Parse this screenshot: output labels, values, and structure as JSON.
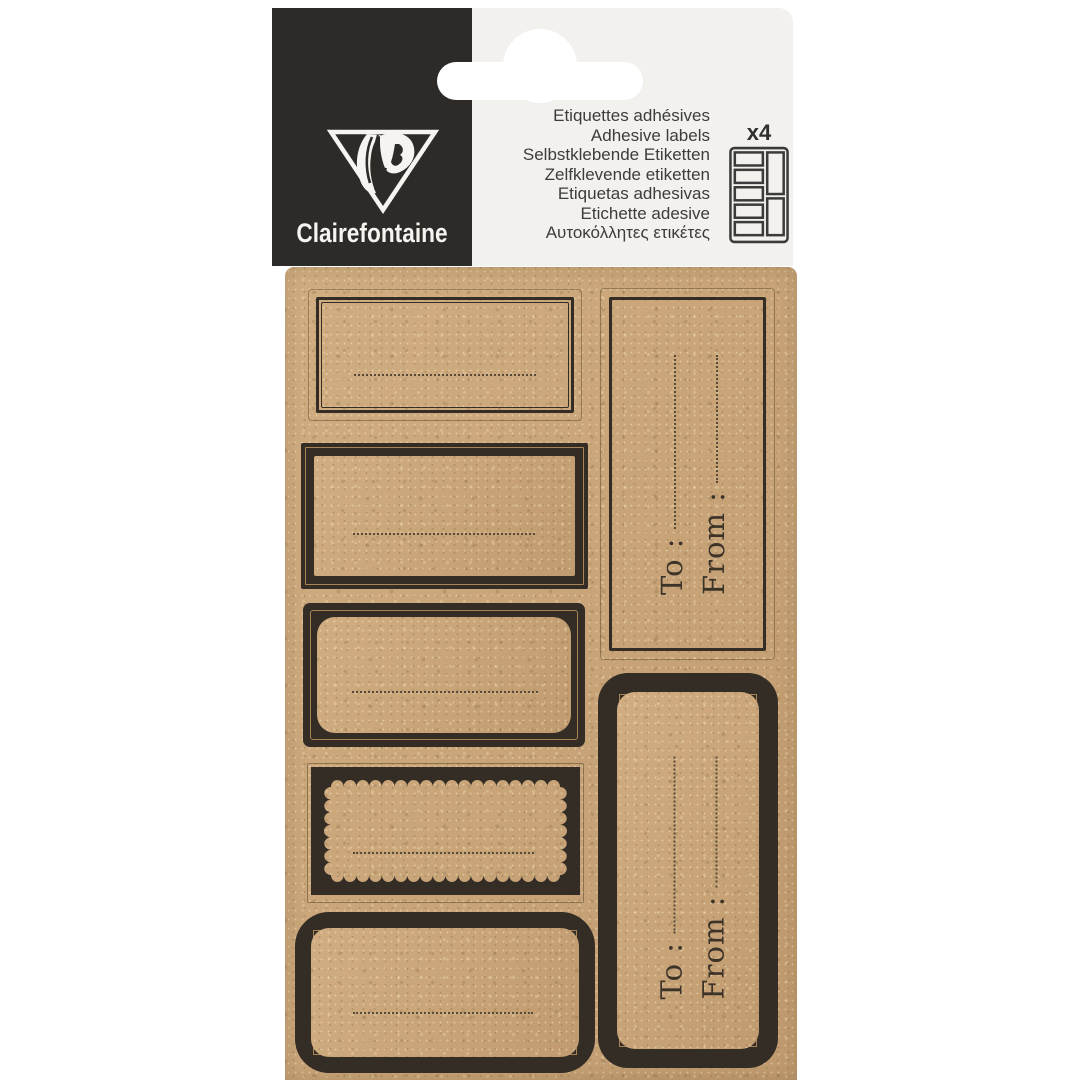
{
  "brand": {
    "name": "Clairefontaine"
  },
  "header": {
    "product_names": [
      "Etiquettes adhésives",
      "Adhesive labels",
      "Selbstklebende Etiketten",
      "Zelfklevende etiketten",
      "Etiquetas adhesivas",
      "Etichette adesive",
      "Αυτοκόλλητες ετικέτες"
    ],
    "count_badge": "x4"
  },
  "gift_tag": {
    "to_label": "To :",
    "from_label": "From :"
  },
  "colors": {
    "charcoal": "#2d2a27",
    "panel_off_white": "#f3f1ed",
    "kraft": "#c9a478",
    "print_black": "#332d26",
    "pinstripe_tan": "#a88455",
    "hang_hole_white": "#ffffff"
  },
  "icons": {
    "logo": "clairefontaine-logo-icon",
    "sheet_layout": "sheet-layout-icon",
    "hang_hole": "hang-hole"
  }
}
